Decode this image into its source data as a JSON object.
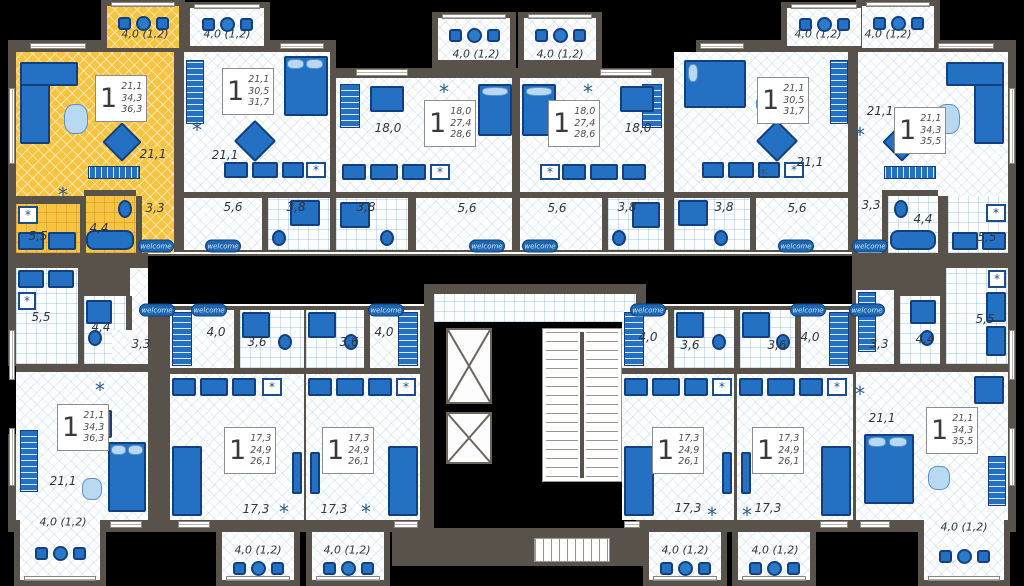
{
  "colors": {
    "highlight": "#f6c440",
    "wall": "#59524a",
    "furniture": "#2470c2",
    "furniture_dark": "#123f7e",
    "furniture_light": "#b9d8f1",
    "mat_blue": "#1d66b0"
  },
  "symbols": {
    "fridge": "*",
    "vent": "*"
  },
  "common": {
    "entry_mat": "welcome"
  },
  "apartments": [
    {
      "id": "top-left",
      "highlighted": true,
      "rooms_count": "1",
      "areas": [
        "21,1",
        "34,3",
        "36,3"
      ],
      "balcony_area": "4,0 (1,2)",
      "labels": {
        "living": "21,1",
        "hall": "3,3",
        "bath": "4,4",
        "kitchen": "5,5"
      }
    },
    {
      "id": "top-2",
      "highlighted": false,
      "rooms_count": "1",
      "areas": [
        "21,1",
        "30,5",
        "31,7"
      ],
      "balcony_area": "4,0 (1,2)",
      "labels": {
        "living": "21,1",
        "hall": "5,6",
        "bath": "3,8"
      }
    },
    {
      "id": "top-3",
      "highlighted": false,
      "rooms_count": "1",
      "areas": [
        "18,0",
        "27,4",
        "28,6"
      ],
      "balcony_area": "4,0 (1,2)",
      "labels": {
        "room": "18,0",
        "hall": "5,6",
        "bath": "3,8"
      }
    },
    {
      "id": "top-4",
      "highlighted": false,
      "rooms_count": "1",
      "areas": [
        "18,0",
        "27,4",
        "28,6"
      ],
      "balcony_area": "4,0 (1,2)",
      "labels": {
        "room": "18,0",
        "hall": "5,6",
        "bath": "3,8"
      }
    },
    {
      "id": "top-5",
      "highlighted": false,
      "rooms_count": "1",
      "areas": [
        "21,1",
        "30,5",
        "31,7"
      ],
      "balcony_area": "4,0 (1,2)",
      "labels": {
        "living": "21,1",
        "hall": "5,6",
        "bath": "3,8"
      }
    },
    {
      "id": "top-right",
      "highlighted": false,
      "rooms_count": "1",
      "areas": [
        "21,1",
        "34,3",
        "35,5"
      ],
      "balcony_area": "4,0 (1,2)",
      "labels": {
        "living": "21,1",
        "hall": "3,3",
        "bath": "4,4",
        "kitchen": "5,5"
      }
    },
    {
      "id": "bottom-left",
      "highlighted": false,
      "rooms_count": "1",
      "areas": [
        "21,1",
        "34,3",
        "36,3"
      ],
      "balcony_area": "4,0 (1,2)",
      "labels": {
        "living": "21,1",
        "hall": "3,3",
        "bath": "4,4",
        "kitchen": "5,5"
      }
    },
    {
      "id": "bottom-2",
      "highlighted": false,
      "rooms_count": "1",
      "areas": [
        "17,3",
        "24,9",
        "26,1"
      ],
      "balcony_area": "4,0 (1,2)",
      "labels": {
        "room": "17,3",
        "hall": "4,0",
        "bath": "3,6"
      }
    },
    {
      "id": "bottom-3",
      "highlighted": false,
      "rooms_count": "1",
      "areas": [
        "17,3",
        "24,9",
        "26,1"
      ],
      "balcony_area": "4,0 (1,2)",
      "labels": {
        "room": "17,3",
        "hall": "4,0",
        "bath": "3,6"
      }
    },
    {
      "id": "bottom-4",
      "highlighted": false,
      "rooms_count": "1",
      "areas": [
        "17,3",
        "24,9",
        "26,1"
      ],
      "balcony_area": "4,0 (1,2)",
      "labels": {
        "room": "17,3",
        "hall": "4,0",
        "bath": "3,6"
      }
    },
    {
      "id": "bottom-5",
      "highlighted": false,
      "rooms_count": "1",
      "areas": [
        "17,3",
        "24,9",
        "26,1"
      ],
      "balcony_area": "4,0 (1,2)",
      "labels": {
        "room": "17,3",
        "hall": "4,0",
        "bath": "3,6"
      }
    },
    {
      "id": "bottom-right",
      "highlighted": false,
      "rooms_count": "1",
      "areas": [
        "21,1",
        "34,3",
        "35,5"
      ],
      "balcony_area": "4,0 (1,2)",
      "labels": {
        "living": "21,1",
        "hall": "3,3",
        "bath": "4,4",
        "kitchen": "5,5"
      }
    }
  ]
}
